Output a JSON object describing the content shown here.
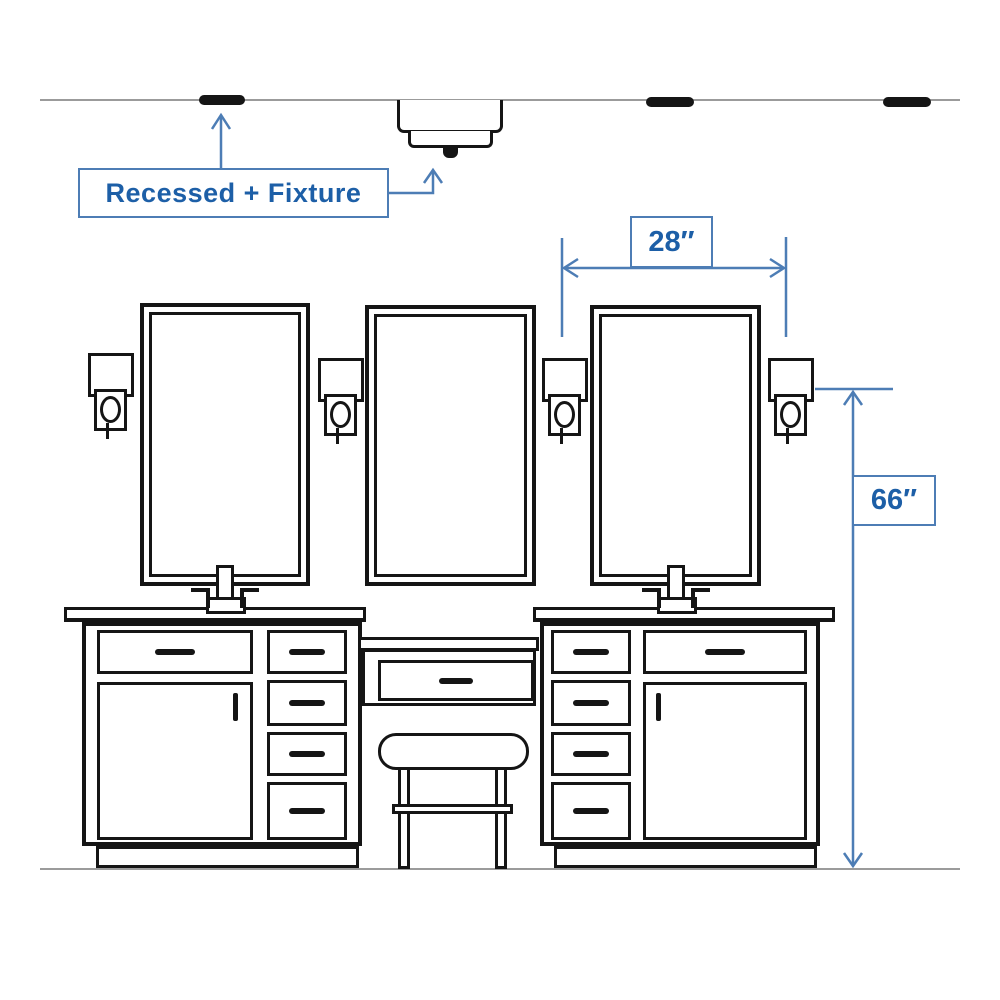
{
  "labels": {
    "recessed_fixture": "Recessed + Fixture",
    "mirror_spacing": "28″",
    "sconce_height": "66″"
  },
  "colors": {
    "dimension_line": "#4d7db5",
    "dimension_text": "#1d5fa7",
    "sketch_ink": "#151515",
    "wall_line": "#9b9b9b",
    "background": "#ffffff"
  },
  "scene": {
    "recessed_light_count": 3,
    "ceiling_fixture_count": 1,
    "mirror_count": 3,
    "sconce_count": 4,
    "vanity_cabinet_count": 2,
    "makeup_stool_count": 1
  }
}
